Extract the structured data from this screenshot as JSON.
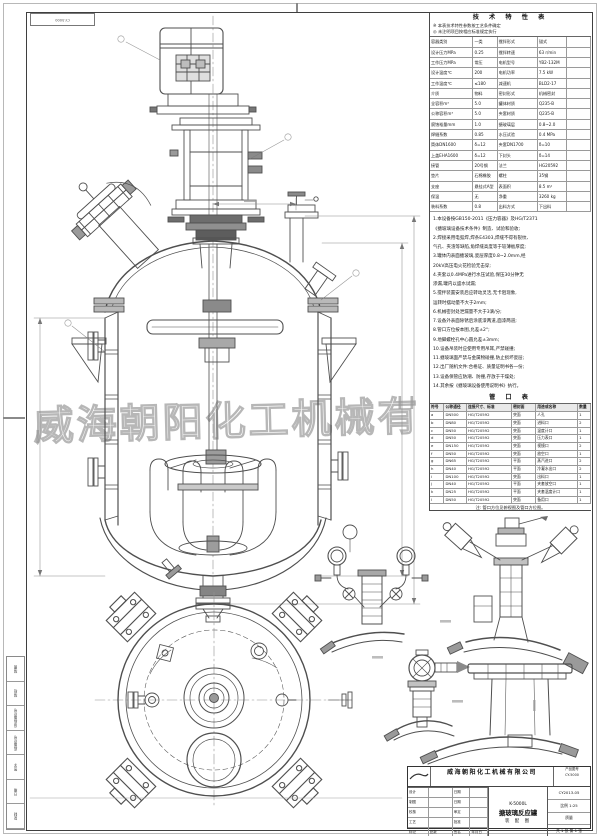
{
  "sheet": {
    "watermark": "威海朝阳化工机械有",
    "corner_code": "CY-5000"
  },
  "spec_table": {
    "title": "技 术 特 性 表",
    "prenotes": [
      "※ 本表技术特性参数按工艺条件确定",
      "◎ 未注明项目按相应标准规定执行"
    ],
    "rows": [
      [
        "容器类别",
        "一类",
        "搅拌形式",
        "锚式",
        ""
      ],
      [
        "设计压力MPa",
        "0.25",
        "搅拌转速",
        "63 r/min",
        ""
      ],
      [
        "工作压力MPa",
        "常压",
        "电机型号",
        "YB2-132M",
        ""
      ],
      [
        "设计温度℃",
        "200",
        "电机功率",
        "7.5 kW",
        ""
      ],
      [
        "工作温度℃",
        "≤180",
        "减速机",
        "BLD2-17",
        ""
      ],
      [
        "介质",
        "物料",
        "密封形式",
        "机械密封",
        ""
      ],
      [
        "全容积m³",
        "5.0",
        "罐体材质",
        "Q235-B",
        ""
      ],
      [
        "公称容积m³",
        "5.0",
        "夹套材质",
        "Q235-B",
        ""
      ],
      [
        "腐蚀裕量mm",
        "1.0",
        "搪玻璃层",
        "0.8~2.0",
        ""
      ],
      [
        "焊缝系数",
        "0.85",
        "水压试验",
        "0.4 MPa",
        ""
      ],
      [
        "筒体DN1600",
        "δ=12",
        "夹套DN1700",
        "δ=10",
        ""
      ],
      [
        "上盖EHA1600",
        "δ=12",
        "下封头",
        "δ=14",
        ""
      ],
      [
        "接管",
        "20号钢",
        "法兰",
        "HG20592",
        ""
      ],
      [
        "垫片",
        "石棉橡胶",
        "螺柱",
        "35钢",
        ""
      ],
      [
        "支座",
        "悬挂式A型",
        "表面积",
        "8.5 m²",
        ""
      ],
      [
        "保温",
        "无",
        "净重",
        "3260 kg",
        ""
      ],
      [
        "装料系数",
        "0.8",
        "出料方式",
        "下出料",
        ""
      ]
    ]
  },
  "notes_block": {
    "lines": [
      "1.本设备按GB150-2011《压力容器》及HG/T2371",
      "《搪玻璃设备技术条件》制造、试验和验收;",
      "2.焊接采用电弧焊,焊条E4303,焊缝不得有裂纹、",
      "气孔、夹渣等缺陷,角焊缝高度等于较薄板厚度;",
      "3.罐体内表面搪玻璃,瓷层厚度0.8~2.0mm,经",
      "20kV高压电火花检验无击穿;",
      "4.夹套以0.4MPa进行水压试验,保压30分钟无",
      "渗漏,罐内以盛水试漏;",
      "5.搅拌装置安装后应转动灵活,无卡阻现象,",
      "运转时摆动量不大于2mm;",
      "6.机械密封处泄漏量不大于3滴/分;",
      "7.设备外表面除锈后涂底漆两道,面漆两道;",
      "8.管口方位按本图,允差±2°;",
      "9.地脚螺栓孔中心圆允差±3mm;",
      "10.设备吊装时应使用专用吊耳,严禁碰撞;",
      "11.搪玻璃面严禁与金属物碰撞,防止损坏瓷层;",
      "12.出厂随机文件:合格证、质量证明书各一份;",
      "13.设备保管应防潮、防撞,存放于干燥处;",
      "14.其余按《搪玻璃设备使用说明书》执行。"
    ]
  },
  "nozzle_table": {
    "title": "管 口 表",
    "rows": [
      [
        "符号",
        "公称通径",
        "连接尺寸、标准",
        "密封面",
        "用途或名称",
        "数量"
      ],
      [
        "a",
        "DN500",
        "HG/T20592",
        "突面",
        "人孔",
        "1"
      ],
      [
        "b",
        "DN80",
        "HG/T20592",
        "突面",
        "进料口",
        "2"
      ],
      [
        "c",
        "DN50",
        "HG/T20592",
        "突面",
        "温度计口",
        "1"
      ],
      [
        "d",
        "DN50",
        "HG/T20592",
        "突面",
        "压力表口",
        "1"
      ],
      [
        "e",
        "DN150",
        "HG/T20592",
        "突面",
        "视镜口",
        "2"
      ],
      [
        "f",
        "DN50",
        "HG/T20592",
        "突面",
        "放空口",
        "1"
      ],
      [
        "g",
        "DN65",
        "HG/T20592",
        "平面",
        "蒸汽进口",
        "2"
      ],
      [
        "h",
        "DN40",
        "HG/T20592",
        "平面",
        "冷凝水出口",
        "2"
      ],
      [
        "i",
        "DN100",
        "HG/T20592",
        "突面",
        "出料口",
        "1"
      ],
      [
        "j",
        "DN40",
        "HG/T20592",
        "平面",
        "夹套放空口",
        "1"
      ],
      [
        "k",
        "DN25",
        "HG/T20592",
        "平面",
        "夹套温度计口",
        "1"
      ],
      [
        "l",
        "DN50",
        "HG/T20592",
        "突面",
        "备用口",
        "1"
      ]
    ],
    "note": "注: 管口方位见俯视图及管口方位图。"
  },
  "title_block": {
    "company": "威海朝阳化工机械有限公司",
    "product_no_label": "产品图号",
    "product_no": "CY-5000",
    "sign_rows": [
      [
        "设计",
        "",
        "日期",
        ""
      ],
      [
        "制图",
        "",
        "日期",
        ""
      ],
      [
        "校核",
        "",
        "审定",
        ""
      ],
      [
        "工艺",
        "",
        "批准",
        ""
      ],
      [
        "标记",
        "处数",
        "签名",
        "年月日"
      ]
    ],
    "model": "K-5000L",
    "title": "搪玻璃反应罐",
    "subtitle": "装 配 图",
    "doc_no": "CY2013-05",
    "scale": "比例 1:25",
    "mass": "质量",
    "sheets": "共 1 张 第 1 张"
  },
  "side_strip": {
    "cells": [
      "描图",
      "描校",
      "旧底图总号",
      "底图总号",
      "签字",
      "日期",
      "复制"
    ]
  }
}
